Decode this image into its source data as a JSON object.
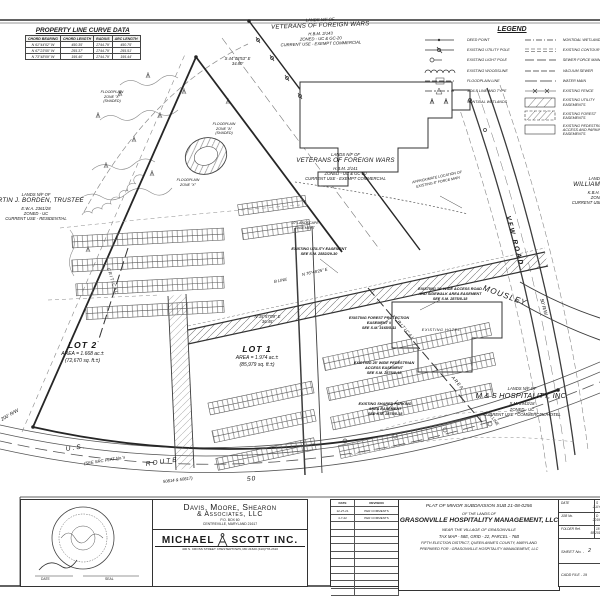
{
  "curve_table": {
    "title": "PROPERTY LINE CURVE DATA",
    "headers": [
      "CHORD BEARING",
      "CHORD LENGTH",
      "RADIUS",
      "ARC LENGTH"
    ],
    "rows": [
      [
        "N 61°44'02\" W",
        "450.35'",
        "2744.79'",
        "450.75'"
      ],
      [
        "N 67°23'55\" W",
        "255.37'",
        "2744.79'",
        "255.51'"
      ],
      [
        "N 73°48'09\" W",
        "195.40'",
        "2744.79'",
        "195.44'"
      ]
    ]
  },
  "legend": {
    "title": "LEGEND",
    "left": [
      "DEED POINT",
      "EXISTING UTILITY POLE",
      "EXISTING LIGHT POLE",
      "EXISTING WOODSLINE",
      "FLOODPLAIN LINE",
      "SOILS LINE AND TYPE",
      "NONTIDAL WETLANDS"
    ],
    "right": [
      "NONTIDAL WETLANDS",
      "EXISTING CONTOUR",
      "SEWER FORCE MAIN",
      "VACUUM SEWER",
      "WATER MAIN",
      "EXISTING FENCE",
      "EXISTING UTILITY EASEMENTS",
      "EXISTING FOREST EASEMENTS",
      "EXISTING PEDESTRIAN ACCESS AND PARKING EASEMENTS"
    ]
  },
  "map": {
    "vfw_top": [
      "LANDS N/F OF",
      "VETERANS OF FOREIGN WARS",
      "H.B.M. 2/143",
      "ZONED - UC & GC-20",
      "CURRENT USE - EXEMPT COMMERCIAL"
    ],
    "vfw_mid": [
      "LANDS N/F OF",
      "VETERANS OF FOREIGN WARS",
      "H.B.M. 2/141",
      "ZONED - UC & GC-20",
      "CURRENT USE - EXEMPT COMMERCIAL"
    ],
    "henry": [
      "LANDS N/F OF",
      "WILLIAM C. HENRY",
      "K.B.H. 3347/219",
      "ZONED - UC",
      "CURRENT USE - COMMERCIAL"
    ],
    "borden": [
      "LANDS N/F OF",
      "MARTIN J. BORDEN, TRUSTEE",
      "E.W.A. 2361/28",
      "ZONED - UC",
      "CURRENT USE - RESIDENTIAL"
    ],
    "ms_hospitality": [
      "LANDS N/F OF",
      "M & S HOSPITALITY, INC.",
      "S.M. 2943/18",
      "ZONED - UC",
      "CURRENT USE - COMMERCIAL/HOTEL"
    ],
    "lot2": [
      "LOT 2",
      "AREA = 1.668 ac.±",
      "(72,670 sq. ft.±)"
    ],
    "lot1": [
      "LOT 1",
      "AREA = 1.974 ac.±",
      "(85,979 sq. ft.±)"
    ],
    "esmt_utility": [
      "EXISTING UTILITY EASEMENT",
      "SEE S.M. 2882/29-30"
    ],
    "esmt_access": [
      "EXISTING 10' WIDE ACCESS ROAD",
      "AND SIDEWALK AREA EASEMENT",
      "SEE S.M. 2875/8-18"
    ],
    "esmt_forest": [
      "EXISTING FOREST PROTECTION",
      "EASEMENT #",
      "SEE S.M. 3165/5-11"
    ],
    "esmt_pedestrian": [
      "EXISTING 25' WIDE PEDESTRIAN",
      "ACCESS EASEMENT",
      "SEE S.M. 2875/8-18"
    ],
    "esmt_parking": [
      "EXISTING SHARED PARKING",
      "AREA EASEMENT",
      "SEE S.M. 2875/8-18"
    ],
    "hotel": "EXISTING HOTEL",
    "force_main": [
      "APPROXIMATE LOCATION OF",
      "EXISTING 8\" FORCE MAIN"
    ],
    "landscape": [
      "10' LANDSCAPE",
      "EASEMENT"
    ],
    "fp1": [
      "FLOODPLAIN",
      "ZONE \"X\"",
      "(SHADED)"
    ],
    "fp2": [
      "FLOODPLAIN",
      "ZONE \"A\"",
      "(SHADED)"
    ],
    "fp3": [
      "FLOODPLAIN",
      "ZONE \"X\""
    ],
    "bearing_a": [
      "S 44°03'53\" E",
      "34.80'"
    ],
    "bearing_b": "N 76°48'25\" E",
    "bearing_c": [
      "N 35°57'09\" E",
      "36.45'"
    ],
    "critical_1": "CRITICAL",
    "critical_2": "AREA",
    "critical_3": "CRITICAL",
    "vfw_road": "VFW ROAD",
    "rw50": "50' R/W",
    "rw200": "200' R/W",
    "mousley": "MOUSLEY",
    "us": "U.S.",
    "route": "ROUTE",
    "fifty": "50",
    "see_plat_1": "(SEE SRC PLAT No.'s",
    "see_plat_2": "50814 & 50817)",
    "line_a": "A LINE",
    "line_b": "B LINE"
  },
  "title_block": {
    "firm1": [
      "Davis, Moore, Shearon",
      "& Associates, LLC"
    ],
    "firm1_addr": [
      "P.O. BOX 60",
      "CENTREVILLE, MARYLAND 21617"
    ],
    "firm2_a": "MICHAEL",
    "firm2_b": "SCOTT INC.",
    "firm2_addr": "400 S. CROSS STREET CHESTERTOWN, MD 21620 (410)778-2310",
    "seal": {
      "date_label": "DATE",
      "seal_label": "SEAL"
    },
    "revisions": {
      "headers": [
        "DATE",
        "REVISION"
      ],
      "rows": [
        [
          "12-27-21",
          "PER COMMENTS"
        ],
        [
          "4-7-22",
          "PER COMMENTS"
        ]
      ]
    },
    "title_lines": [
      "PLAT OF MINOR SUBDIVISION SUB 21-08-0256",
      "OF THE LANDS OF",
      "GRASONVILLE HOSPITALITY MANAGEMENT, LLC",
      "NEAR THE VILLAGE OF GRASONVILLE",
      "TAX MAP - 58E, GRID - 22, PARCEL - 76B",
      "FIFTH ELECTION DISTRICT, QUEEN ANNE'S COUNTY, MARYLAND",
      "PREPARED FOR : GRASONVILLE HOSPITALITY MANAGEMENT, LLC"
    ],
    "info": {
      "date_label": "DATE",
      "date": "JULY '21",
      "job_label": "JOB No.",
      "job": "2019012",
      "folder_label": "FOLDER Ref.",
      "folder": "58-2019012",
      "sheet_label": "SHEET No. -",
      "sheet": "2",
      "cadd": "CADD FILE - 19",
      "cut1": "S",
      "cut2": "D",
      "cut3": "18"
    }
  }
}
